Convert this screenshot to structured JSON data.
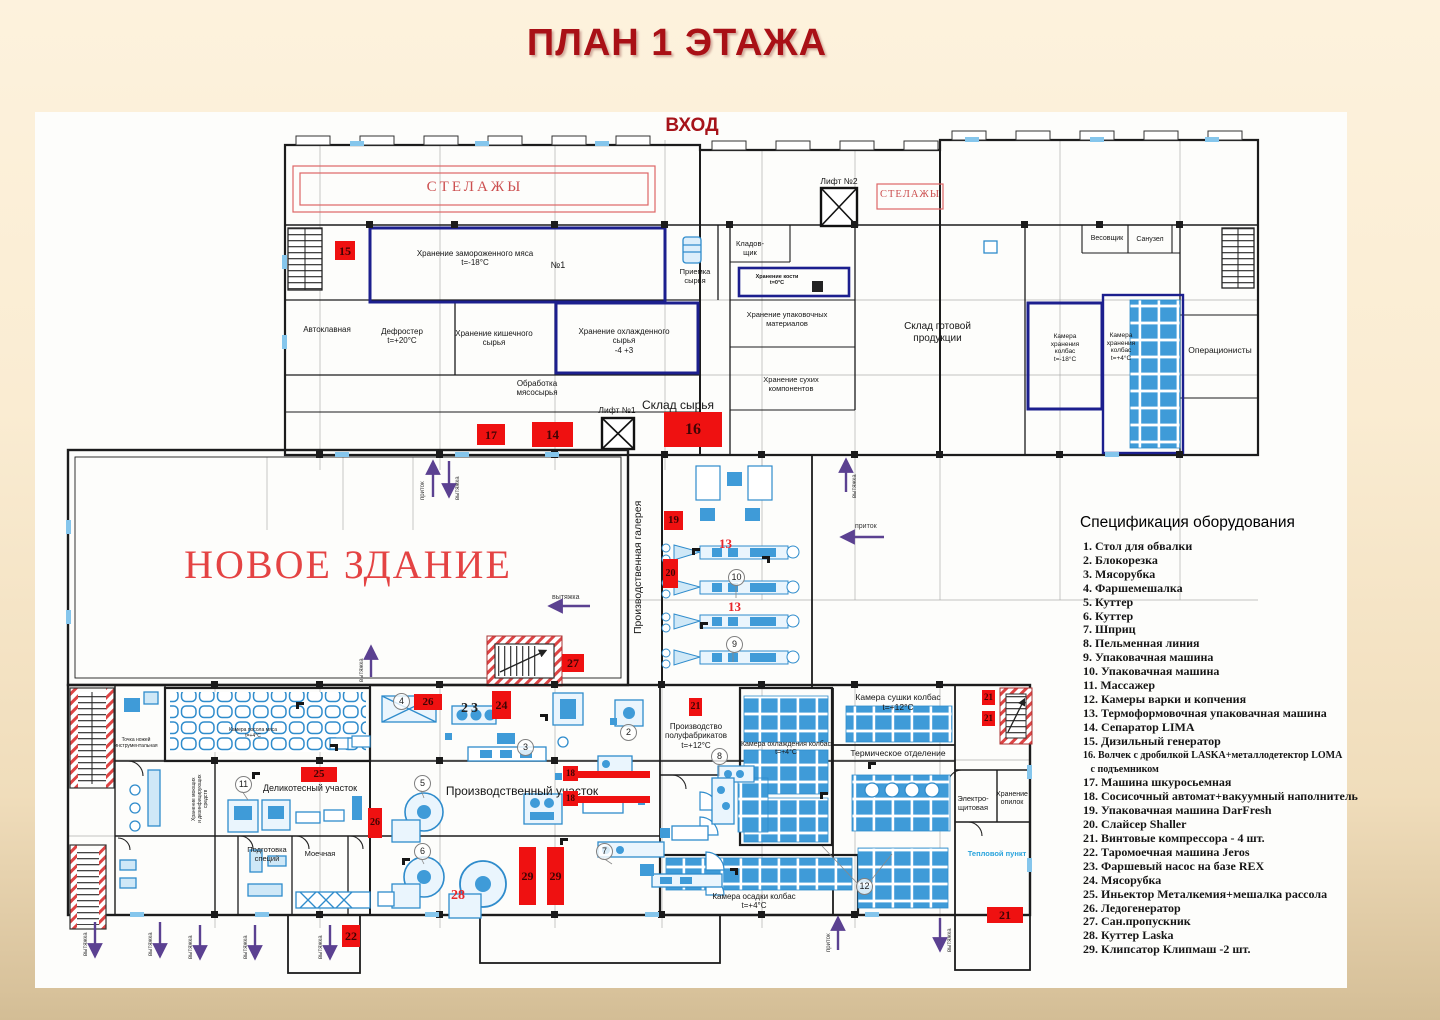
{
  "header": {
    "title": "ПЛАН 1 ЭТАЖА",
    "entrance": "ВХОД"
  },
  "buildings": {
    "new_building": "НОВОЕ ЗДАНИЕ",
    "gallery": "Производственная галерея"
  },
  "rooms": {
    "shelves_left": "СТЕЛАЖЫ",
    "shelves_right": "СТЕЛАЖЫ",
    "lift2": "Лифт №2",
    "lift1": "Лифт №1",
    "frozen_meat": "Хранение замороженного мяса\nt=-18°C",
    "room_no1": "№1",
    "autoclave": "Автоклавная",
    "defroster": "Дефростер\nt=+20°C",
    "gut_storage": "Хранение кишечного\nсырья",
    "chilled_storage": "Хранение охлажденного\nсырья\n-4 +3",
    "meat_processing": "Обработка\nмясосырья",
    "raw_intake": "Приемка\nсырья",
    "storekeeper": "Кладов-\nщик",
    "bone_storage": "Хранение кости\nt=0°C",
    "packaging_storage": "Хранение упаковочных\nматериалов",
    "finished_goods": "Склад готовой\nпродукции",
    "dry_components": "Хранение сухих\nкомпонентов",
    "sausage_cold_store": "Камера\nхранения\nколбас\nt=-18°C",
    "sausage_cool_store": "Камера\nхранения\nколбас\nt=+4°C",
    "weigher": "Весовщик",
    "wc": "Санузел",
    "operators": "Операционисты",
    "raw_warehouse": "Склад сырья",
    "knife_point": "Точка ножей\nинструментальная",
    "salting_chamber": "Камера посола мяса\nt=+4°C",
    "deli_section": "Деликотесный участок",
    "detergents_storage": "Хранение моющих\nи дезинфицирующих\nсредств",
    "spice_prep": "Подготовка\nспеций",
    "washing_room": "Моечная",
    "production_area": "Производственный участок",
    "semifinished": "Производство\nполуфабрикатов\nt=+12°C",
    "sausage_cooling": "Камера охлаждения колбас\nt=+4°C",
    "sausage_drying": "Камера сушки колбас\nt=+12°C",
    "thermal_dept": "Термическое отделение",
    "sausage_settling": "Камера осадки колбас\nt=+4°C",
    "electrical_room": "Электро-\nщитовая",
    "sawdust_storage": "Хранение\nопилок",
    "heating_point": "Тепловой пункт"
  },
  "vents": {
    "supply": "приток",
    "exhaust": "вытяжка"
  },
  "markers": {
    "m13a": "13",
    "m13b": "13",
    "m14": "14",
    "m15": "15",
    "m16": "16",
    "m17": "17",
    "m18a": "18",
    "m18b": "18",
    "m19": "19",
    "m20": "20",
    "m21a": "21",
    "m21b": "21",
    "m21c": "21",
    "m21d": "21",
    "m22": "22",
    "m23": "23",
    "m24": "24",
    "m25": "25",
    "m26a": "26",
    "m26b": "26",
    "m27": "27",
    "m28": "28",
    "m29a": "29",
    "m29b": "29"
  },
  "circled": {
    "c2": "2",
    "c3": "3",
    "c4": "4",
    "c5": "5",
    "c6": "6",
    "c7": "7",
    "c8": "8",
    "c9": "9",
    "c10": "10",
    "c11": "11",
    "c12": "12"
  },
  "spec": {
    "title": "Спецификация оборудования",
    "items": [
      "1. Стол для обвалки",
      "2. Блокорезка",
      "3. Мясорубка",
      "4. Фаршемешалка",
      "5. Куттер",
      "6. Куттер",
      "7. Шприц",
      "8. Пельменная линия",
      "9. Упаковачная машина",
      "10. Упаковачная машина",
      "11. Массажер",
      "12. Камеры варки и копчения",
      "13. Термоформовочная упаковачная машина",
      "14. Сепаратор LIMA",
      "15. Дизильный генератор",
      "16. Волчек с дробилкой LASKA+металлодетектор LOMA\n   с подъемником",
      "17.  Машина шкуросьемная",
      "18. Сосисочный автомат+вакуумный наполнитель",
      "19. Упаковачная машина DarFresh",
      "20. Слайсер Shaller",
      "21. Винтовые компрессора - 4 шт.",
      "22. Таромоечная машина Jeros",
      "23. Фаршевый насос на базе REX",
      "24. Мясорубка",
      "25. Иньектор Металкемия+мешалка рассола",
      "26. Ледогенератор",
      "27. Сан.пропускник",
      "28. Куттер Laska",
      "29. Клипсатор Клипмаш -2 шт."
    ]
  }
}
